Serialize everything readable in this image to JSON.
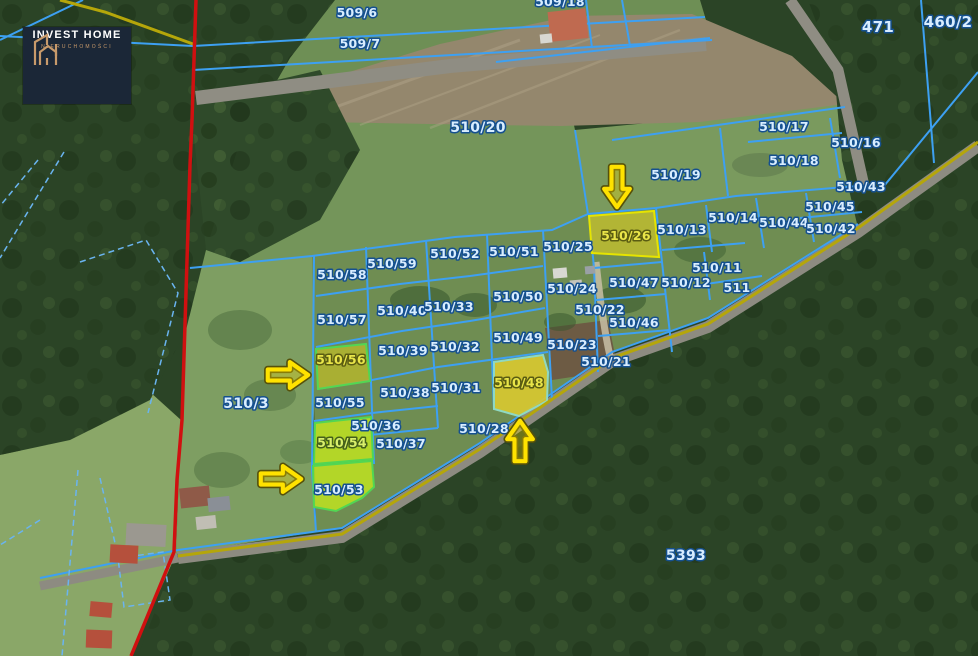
{
  "branding": {
    "logo_title": "INVEST HOME",
    "logo_subtitle": "NIERUCHOMOŚCI",
    "logo_bg": "#1b2737",
    "logo_accent": "#c89a6b"
  },
  "map": {
    "colors": {
      "parcel_boundary_blue": "#3da0f2",
      "municipal_border_red": "#d01010",
      "road_edge_olive": "#b5a60a",
      "highlight_yellow": "#c3bf2e",
      "highlight_green": "#b9dc25",
      "arrow_yellow": "#ffe200",
      "label_blue": "#d8edff"
    },
    "highlighted_parcels": [
      "510/26",
      "510/48",
      "510/56",
      "510/54",
      "510/53"
    ],
    "arrows": [
      {
        "direction": "down",
        "x": 617,
        "y": 187,
        "target": "510/26"
      },
      {
        "direction": "right",
        "x": 288,
        "y": 375,
        "target": "510/56"
      },
      {
        "direction": "right",
        "x": 281,
        "y": 479,
        "target": "510/53"
      },
      {
        "direction": "up",
        "x": 520,
        "y": 441,
        "target": "510/48"
      }
    ],
    "parcels": [
      {
        "label": "509/6",
        "x": 357,
        "y": 13
      },
      {
        "label": "509/7",
        "x": 360,
        "y": 44
      },
      {
        "label": "509/18",
        "x": 560,
        "y": 2
      },
      {
        "label": "471",
        "x": 878,
        "y": 28,
        "size": 15
      },
      {
        "label": "460/2",
        "x": 948,
        "y": 23,
        "size": 15
      },
      {
        "label": "510/20",
        "x": 478,
        "y": 128,
        "size": 14
      },
      {
        "label": "510/17",
        "x": 784,
        "y": 127
      },
      {
        "label": "510/16",
        "x": 856,
        "y": 143
      },
      {
        "label": "510/18",
        "x": 794,
        "y": 161
      },
      {
        "label": "510/19",
        "x": 676,
        "y": 175
      },
      {
        "label": "510/43",
        "x": 861,
        "y": 187
      },
      {
        "label": "510/45",
        "x": 830,
        "y": 207
      },
      {
        "label": "510/44",
        "x": 784,
        "y": 223
      },
      {
        "label": "510/42",
        "x": 831,
        "y": 229
      },
      {
        "label": "510/14",
        "x": 733,
        "y": 218
      },
      {
        "label": "510/13",
        "x": 682,
        "y": 230
      },
      {
        "label": "510/26",
        "x": 626,
        "y": 236,
        "style": "yellow"
      },
      {
        "label": "510/25",
        "x": 568,
        "y": 247
      },
      {
        "label": "510/11",
        "x": 717,
        "y": 268
      },
      {
        "label": "510/12",
        "x": 686,
        "y": 283
      },
      {
        "label": "511",
        "x": 737,
        "y": 288
      },
      {
        "label": "510/47",
        "x": 634,
        "y": 283
      },
      {
        "label": "510/24",
        "x": 572,
        "y": 289
      },
      {
        "label": "510/22",
        "x": 600,
        "y": 310
      },
      {
        "label": "510/46",
        "x": 634,
        "y": 323
      },
      {
        "label": "510/23",
        "x": 572,
        "y": 345
      },
      {
        "label": "510/21",
        "x": 606,
        "y": 362
      },
      {
        "label": "510/52",
        "x": 455,
        "y": 254
      },
      {
        "label": "510/51",
        "x": 514,
        "y": 252
      },
      {
        "label": "510/59",
        "x": 392,
        "y": 264
      },
      {
        "label": "510/58",
        "x": 342,
        "y": 275
      },
      {
        "label": "510/50",
        "x": 518,
        "y": 297
      },
      {
        "label": "510/40",
        "x": 402,
        "y": 311
      },
      {
        "label": "510/33",
        "x": 449,
        "y": 307
      },
      {
        "label": "510/57",
        "x": 342,
        "y": 320
      },
      {
        "label": "510/49",
        "x": 518,
        "y": 338
      },
      {
        "label": "510/32",
        "x": 455,
        "y": 347
      },
      {
        "label": "510/39",
        "x": 403,
        "y": 351
      },
      {
        "label": "510/56",
        "x": 341,
        "y": 360,
        "style": "yellow"
      },
      {
        "label": "510/38",
        "x": 405,
        "y": 393
      },
      {
        "label": "510/31",
        "x": 456,
        "y": 388
      },
      {
        "label": "510/55",
        "x": 340,
        "y": 403
      },
      {
        "label": "510/3",
        "x": 246,
        "y": 404,
        "size": 14
      },
      {
        "label": "510/48",
        "x": 519,
        "y": 383,
        "style": "yellow"
      },
      {
        "label": "510/36",
        "x": 376,
        "y": 426
      },
      {
        "label": "510/37",
        "x": 401,
        "y": 444
      },
      {
        "label": "510/54",
        "x": 342,
        "y": 443,
        "style": "green"
      },
      {
        "label": "510/28",
        "x": 484,
        "y": 429
      },
      {
        "label": "510/53",
        "x": 339,
        "y": 490
      },
      {
        "label": "5393",
        "x": 686,
        "y": 556,
        "size": 14
      }
    ]
  }
}
